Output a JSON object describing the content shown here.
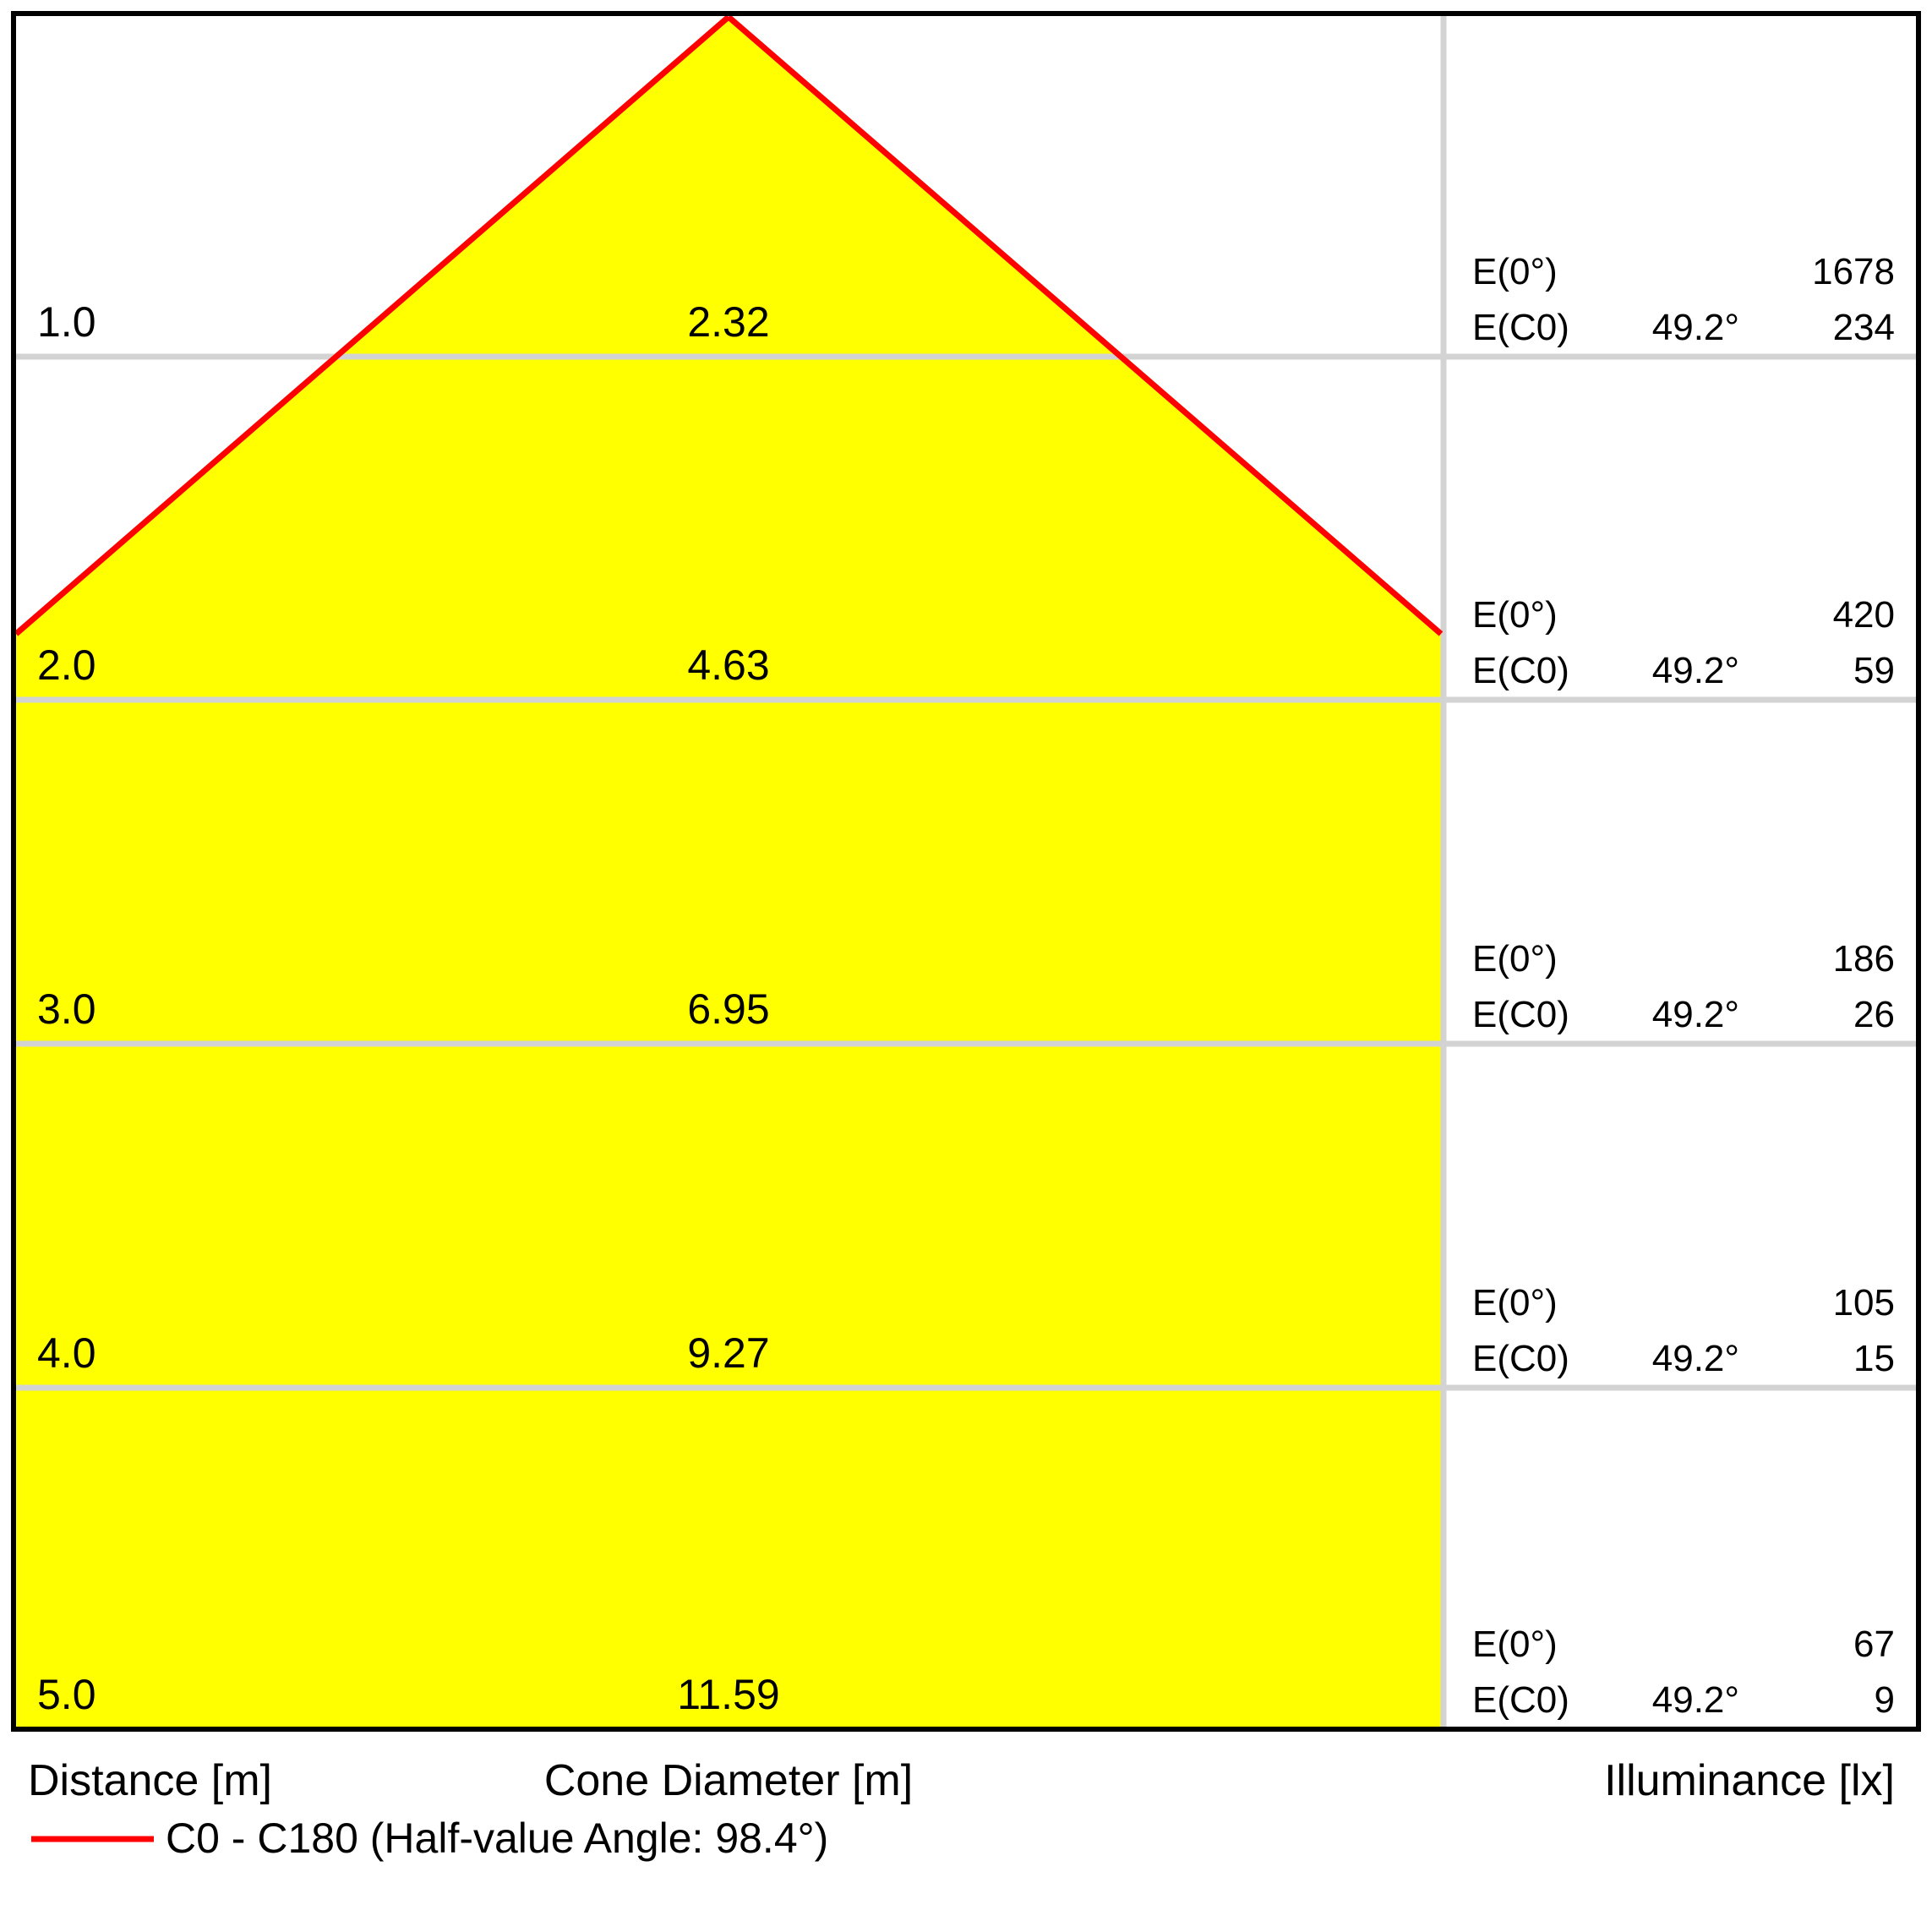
{
  "colors": {
    "cone_fill": "#ffff00",
    "cone_line": "#ff0000",
    "grid": "#d3d3d3",
    "border": "#000000",
    "text": "#000000"
  },
  "rows": [
    {
      "distance": "1.0",
      "diameter": "2.32",
      "e0_label": "E(0°)",
      "e0_value": "1678",
      "ec0_label": "E(C0)",
      "angle": "49.2°",
      "ec0_value": "234"
    },
    {
      "distance": "2.0",
      "diameter": "4.63",
      "e0_label": "E(0°)",
      "e0_value": "420",
      "ec0_label": "E(C0)",
      "angle": "49.2°",
      "ec0_value": "59"
    },
    {
      "distance": "3.0",
      "diameter": "6.95",
      "e0_label": "E(0°)",
      "e0_value": "186",
      "ec0_label": "E(C0)",
      "angle": "49.2°",
      "ec0_value": "26"
    },
    {
      "distance": "4.0",
      "diameter": "9.27",
      "e0_label": "E(0°)",
      "e0_value": "105",
      "ec0_label": "E(C0)",
      "angle": "49.2°",
      "ec0_value": "15"
    },
    {
      "distance": "5.0",
      "diameter": "11.59",
      "e0_label": "E(0°)",
      "e0_value": "67",
      "ec0_label": "E(C0)",
      "angle": "49.2°",
      "ec0_value": "9"
    }
  ],
  "footer": {
    "distance_label": "Distance [m]",
    "diameter_label": "Cone Diameter [m]",
    "illuminance_label": "Illuminance [lx]"
  },
  "legend": {
    "label": "C0 - C180 (Half-value Angle: 98.4°)"
  },
  "chart_data": {
    "type": "area",
    "title": "Light cone diagram, C0 - C180 plane",
    "x": [
      1.0,
      2.0,
      3.0,
      4.0,
      5.0
    ],
    "xlabel": "Distance [m]",
    "series": [
      {
        "name": "Cone Diameter [m]",
        "values": [
          2.32,
          4.63,
          6.95,
          9.27,
          11.59
        ]
      },
      {
        "name": "E(0°) Illuminance [lx]",
        "values": [
          1678,
          420,
          186,
          105,
          67
        ]
      },
      {
        "name": "E(C0) 49.2° Illuminance [lx]",
        "values": [
          234,
          59,
          26,
          15,
          9
        ]
      }
    ],
    "beam_half_angle_deg": 49.2,
    "half_value_angle_deg": 98.4,
    "legend": "C0 - C180 (Half-value Angle: 98.4°)",
    "legend_position": "bottom-left",
    "grid": true,
    "cone_fill_color": "#ffff00",
    "cone_line_color": "#ff0000"
  }
}
